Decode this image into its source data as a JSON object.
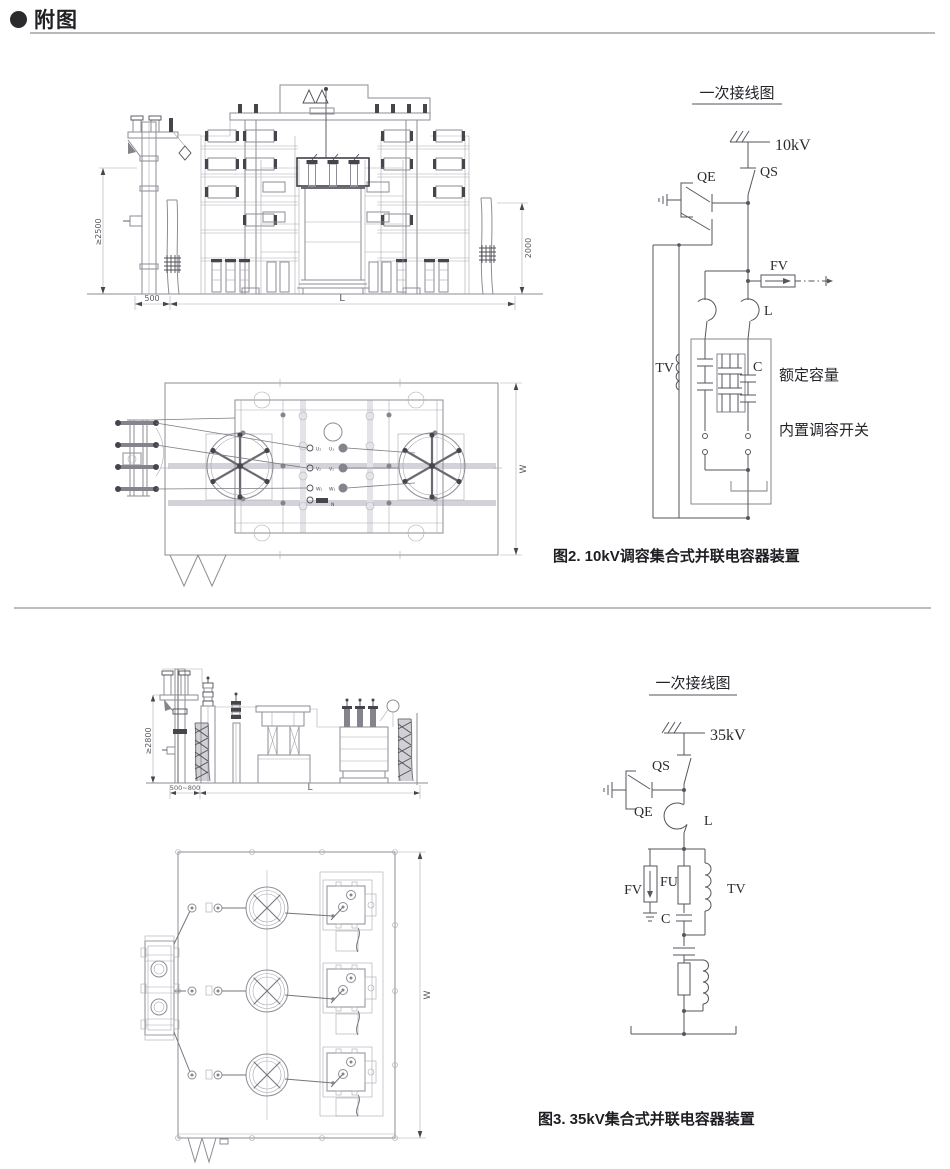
{
  "page": {
    "header_title": "附图"
  },
  "fig2": {
    "caption": "图2. 10kV调容集合式并联电容器装置",
    "front_view": {
      "dim_pole_height": "≥2500",
      "dim_pole_offset": "500",
      "dim_length": "L",
      "dim_fence_height": "2000"
    },
    "plan_view": {
      "dim_width": "W",
      "terminals": {
        "u2": "U₂",
        "u1": "U₁",
        "v2": "V₂",
        "v1": "V₁",
        "w2": "W₂",
        "w1": "W₁",
        "n": "N"
      }
    },
    "schematic": {
      "title": "一次接线图",
      "labels": {
        "voltage": "10kV",
        "qs": "QS",
        "qe": "QE",
        "fv": "FV",
        "l": "L",
        "tv": "TV",
        "c": "C",
        "rated_capacity": "额定容量",
        "builtin_switch": "内置调容开关"
      }
    }
  },
  "fig3": {
    "caption": "图3. 35kV集合式并联电容器装置",
    "front_view": {
      "dim_pole_height": "≥2800",
      "dim_pole_offset": "500~800",
      "dim_length": "L"
    },
    "plan_view": {
      "dim_width": "W"
    },
    "schematic": {
      "title": "一次接线图",
      "labels": {
        "voltage": "35kV",
        "qs": "QS",
        "qe": "QE",
        "l": "L",
        "fv": "FV",
        "fu": "FU",
        "tv": "TV",
        "c": "C"
      }
    }
  }
}
